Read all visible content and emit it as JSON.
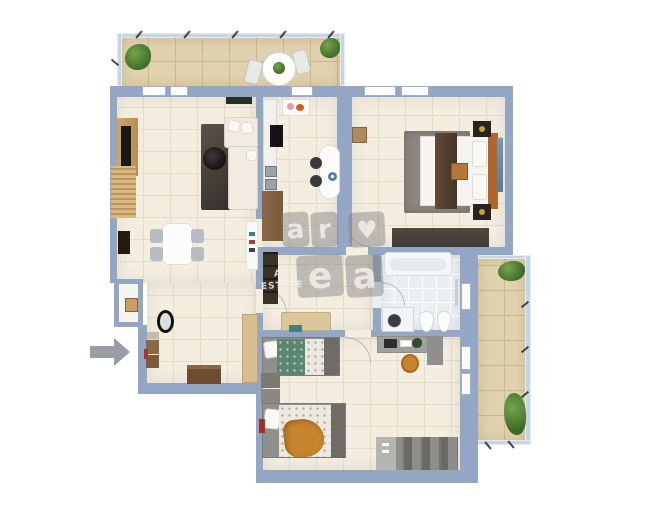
{
  "watermark": {
    "letters": [
      "a",
      "r",
      "♥",
      "e",
      "a"
    ],
    "caption_line1": "AL",
    "caption_line2": "ESTATE"
  },
  "colors": {
    "wall": "#93a7c4",
    "railing": "#c5d5e2",
    "floor": "#f4eee1",
    "floorLine": "#e6ddc9",
    "balconyFloor": "#e2d1ae",
    "balconyLine": "#cdb98f",
    "bathFloor": "#eceff2",
    "bathLine": "#ffffff",
    "closetFloor": "#f6f5f1",
    "wood": "#c99e63",
    "woodDark": "#8a6240",
    "counterBrown": "#7a5a3c",
    "darkFurniture": "#3a3128",
    "rugDark": "#45403a",
    "rugGray": "#8d8781",
    "sofa": "#f1ebe2",
    "chairGray": "#b7bcc2",
    "steel": "#9aa3a9",
    "bedFrameOrange": "#b0662a",
    "runnerBrown": "#55422f",
    "benchDark": "#4f4940",
    "kidsGray": "#8f8f8d",
    "duvetGreen": "#5d8573",
    "blanketOrange": "#c8842f",
    "deskGray": "#a0a09e",
    "plantGreen": "#4d7c36",
    "arrowGray": "#9a9da3",
    "wmBg": "rgba(125,125,125,0.45)",
    "wmInk": "rgba(240,238,234,0.85)"
  }
}
